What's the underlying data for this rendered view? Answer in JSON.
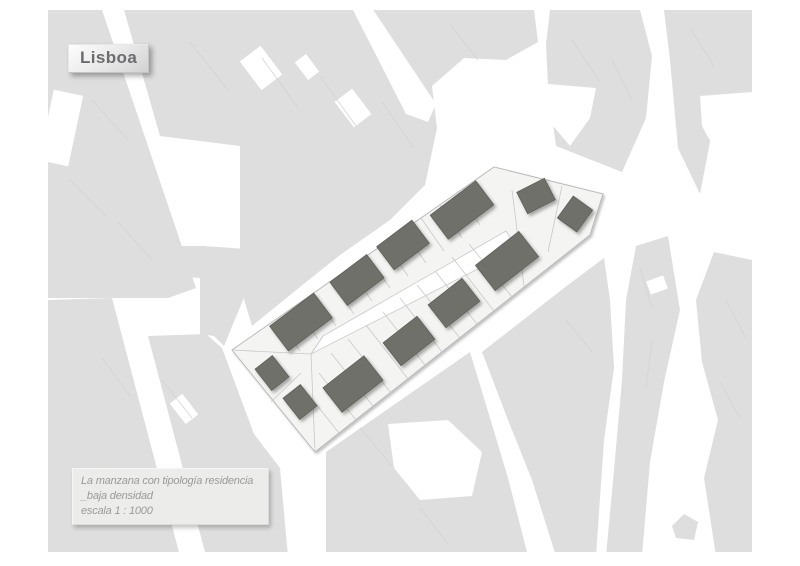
{
  "map": {
    "title_label": "Lisboa",
    "caption": {
      "lines": [
        "La manzana con tipología residencia",
        "_baja densidad",
        "escala 1 : 1000"
      ]
    },
    "colors": {
      "page_bg": "#ffffff",
      "context_fill": "#dedede",
      "context_line": "#d2d2d2",
      "street": "#ffffff",
      "block_fill": "#f4f4f2",
      "block_stroke": "#b5b5b5",
      "parcel_line": "#c9c9c9",
      "building_fill": "#70706a",
      "building_stroke": "#5e5e59",
      "title_color": "#6c6c70",
      "caption_color": "#9a9a9a"
    },
    "block": {
      "outline": [
        [
          232,
          350
        ],
        [
          494,
          167
        ],
        [
          603,
          194
        ],
        [
          590,
          235
        ],
        [
          315,
          452
        ]
      ],
      "courtyard": [
        [
          323,
          336
        ],
        [
          506,
          231
        ],
        [
          517,
          249
        ],
        [
          311,
          354
        ]
      ],
      "parcel_lines": [
        [
          277,
          319,
          300,
          351
        ],
        [
          295,
          306,
          318,
          339
        ],
        [
          313,
          293,
          336,
          326
        ],
        [
          331,
          281,
          354,
          314
        ],
        [
          349,
          268,
          372,
          301
        ],
        [
          367,
          256,
          390,
          288
        ],
        [
          385,
          243,
          408,
          276
        ],
        [
          403,
          230,
          426,
          263
        ],
        [
          421,
          218,
          444,
          251
        ],
        [
          440,
          205,
          462,
          238
        ],
        [
          458,
          193,
          480,
          225
        ],
        [
          339,
          433,
          308,
          394
        ],
        [
          356,
          420,
          319,
          373
        ],
        [
          373,
          406,
          331,
          353
        ],
        [
          391,
          393,
          348,
          339
        ],
        [
          408,
          379,
          366,
          325
        ],
        [
          425,
          365,
          383,
          312
        ],
        [
          442,
          352,
          400,
          298
        ],
        [
          460,
          338,
          417,
          285
        ],
        [
          477,
          324,
          435,
          271
        ],
        [
          494,
          311,
          452,
          257
        ],
        [
          512,
          297,
          469,
          244
        ],
        [
          232,
          350,
          311,
          354
        ],
        [
          311,
          354,
          315,
          452
        ],
        [
          311,
          354,
          323,
          336
        ],
        [
          512,
          190,
          524,
          286
        ],
        [
          562,
          186,
          548,
          252
        ],
        [
          271,
          402,
          301,
          373
        ]
      ],
      "buildings": [
        {
          "cx": 301,
          "cy": 322,
          "w": 55,
          "h": 31,
          "a": -37
        },
        {
          "cx": 357,
          "cy": 280,
          "w": 46,
          "h": 29,
          "a": -37
        },
        {
          "cx": 403,
          "cy": 245,
          "w": 44,
          "h": 29,
          "a": -37
        },
        {
          "cx": 462,
          "cy": 210,
          "w": 57,
          "h": 30,
          "a": -37
        },
        {
          "cx": 536,
          "cy": 196,
          "w": 31,
          "h": 24,
          "a": -27
        },
        {
          "cx": 575,
          "cy": 214,
          "w": 24,
          "h": 27,
          "a": 36
        },
        {
          "cx": 272,
          "cy": 373,
          "w": 22,
          "h": 27,
          "a": -38
        },
        {
          "cx": 300,
          "cy": 402,
          "w": 22,
          "h": 27,
          "a": -38
        },
        {
          "cx": 353,
          "cy": 384,
          "w": 52,
          "h": 31,
          "a": -38
        },
        {
          "cx": 409,
          "cy": 341,
          "w": 43,
          "h": 29,
          "a": -38
        },
        {
          "cx": 454,
          "cy": 303,
          "w": 43,
          "h": 29,
          "a": -38
        },
        {
          "cx": 507,
          "cy": 261,
          "w": 55,
          "h": 32,
          "a": -38
        }
      ]
    }
  }
}
